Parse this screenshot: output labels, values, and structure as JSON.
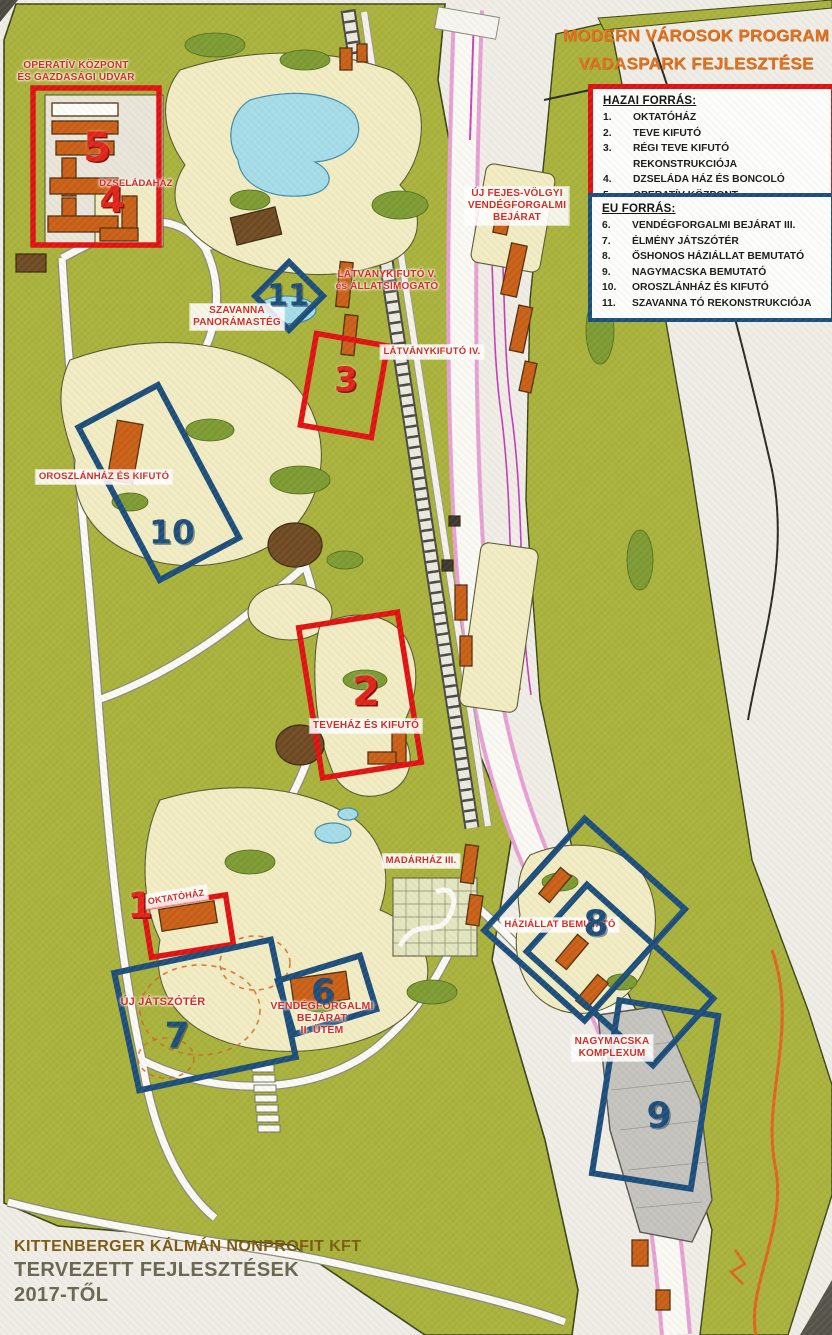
{
  "title": {
    "line1": "MODERN VÁROSOK PROGRAM",
    "line2": "VADASPARK FEJLESZTÉSE"
  },
  "legend_domestic": {
    "heading": "HAZAI FORRÁS:",
    "items": [
      {
        "num": "1.",
        "label": "OKTATÓHÁZ"
      },
      {
        "num": "2.",
        "label": "TEVE KIFUTÓ"
      },
      {
        "num": "3.",
        "label": "RÉGI TEVE KIFUTÓ REKONSTRUKCIÓJA"
      },
      {
        "num": "4.",
        "label": "DZSELÁDA HÁZ ÉS BONCOLÓ"
      },
      {
        "num": "5.",
        "label": "OPERATÍV KÖZPONT"
      }
    ]
  },
  "legend_eu": {
    "heading": "EU FORRÁS:",
    "items": [
      {
        "num": "6.",
        "label": "VENDÉGFORGALMI BEJÁRAT III."
      },
      {
        "num": "7.",
        "label": "ÉLMÉNY JÁTSZÓTÉR"
      },
      {
        "num": "8.",
        "label": "ŐSHONOS HÁZIÁLLAT BEMUTATÓ"
      },
      {
        "num": "9.",
        "label": "NAGYMACSKA BEMUTATÓ"
      },
      {
        "num": "10.",
        "label": "OROSZLÁNHÁZ ÉS KIFUTÓ"
      },
      {
        "num": "11.",
        "label": "SZAVANNA TÓ REKONSTRUKCIÓJA"
      }
    ]
  },
  "footer": {
    "line1": "KITTENBERGER KÁLMÁN NONPROFIT KFT",
    "line2": "TERVEZETT FEJLESZTÉSEK",
    "line3": "2017-TŐL"
  },
  "map_labels": {
    "operativ": "OPERATÍV KÖZPONT\nÉS GAZDASÁGI UDVAR",
    "dzseladahaz": "DZSELÁDAHÁZ",
    "szavanna": "SZAVANNA\nPANORÁMASTÉG",
    "latvanykifuto_v": "LÁTVÁNYKIFUTÓ V.\nés ÁLLATSIMOGATÓ",
    "latvanykifuto_iv": "LÁTVÁNYKIFUTÓ IV.",
    "uj_fejes": "ÚJ FEJES-VÖLGYI\nVENDÉGFORGALMI\nBEJÁRAT",
    "oroszlanhaz": "OROSZLÁNHÁZ ÉS KIFUTÓ",
    "tevehaz": "TEVEHÁZ ÉS KIFUTÓ",
    "madarhaz": "MADÁRHÁZ III.",
    "oktatohaz": "OKTATÓHÁZ",
    "uj_jatszoter": "ÚJ JÁTSZÓTÉR",
    "vendegforgalmi": "VENDÉGFORGALMI\nBEJÁRAT\nII. ÜTEM",
    "haziallat": "HÁZIÁLLAT BEMUTATÓ",
    "nagymacska": "NAGYMACSKA\nKOMPLEXUM"
  },
  "markers": {
    "n1": "1",
    "n2": "2",
    "n3": "3",
    "n4": "4",
    "n5": "5",
    "n6": "6",
    "n7": "7",
    "n8": "8",
    "n9": "9",
    "n10": "10",
    "n11": "11"
  },
  "colors": {
    "domestic_accent": "#dd1212",
    "eu_accent": "#1d4e7a",
    "title_orange": "#e2711d",
    "map_olive": "#a9b23b",
    "map_beige": "#f2ecc3",
    "label_red": "#d42a1e"
  }
}
